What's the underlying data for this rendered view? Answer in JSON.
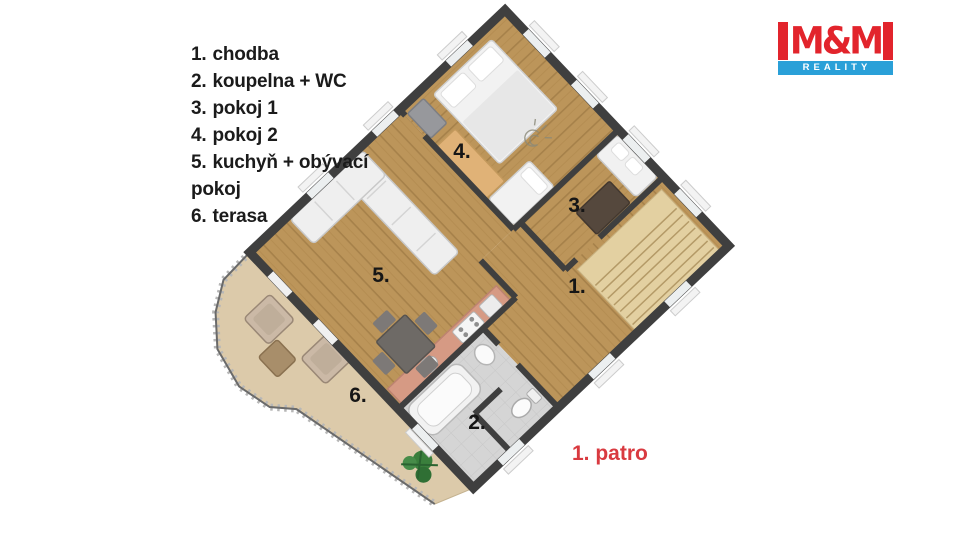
{
  "legend": {
    "items": [
      {
        "number": "1.",
        "label": "chodba"
      },
      {
        "number": "2.",
        "label": "koupelna + WC"
      },
      {
        "number": "3.",
        "label": "pokoj 1"
      },
      {
        "number": "4.",
        "label": "pokoj 2"
      },
      {
        "number": "5.",
        "label": "kuchyň + obývací pokoj"
      },
      {
        "number": "6.",
        "label": "terasa"
      }
    ]
  },
  "plan": {
    "labels": {
      "r1": "1.",
      "r2": "2.",
      "r3": "3.",
      "r4": "4.",
      "r5": "5.",
      "r6": "6."
    },
    "floor_label": "1. patro"
  },
  "logo": {
    "title": "M&M",
    "subtitle": "REALITY"
  },
  "palette": {
    "logo_red": "#e2242c",
    "logo_blue": "#2aa0d8",
    "floor_label_red": "#d93a40",
    "wood_floor": "#bc955a",
    "terrace_floor": "#dccaaa",
    "bathroom_tile": "#d5d5d5",
    "stairs": "#e3d0a1",
    "kitchen_counter": "#d69a84",
    "wall": "#3f3f3f"
  }
}
